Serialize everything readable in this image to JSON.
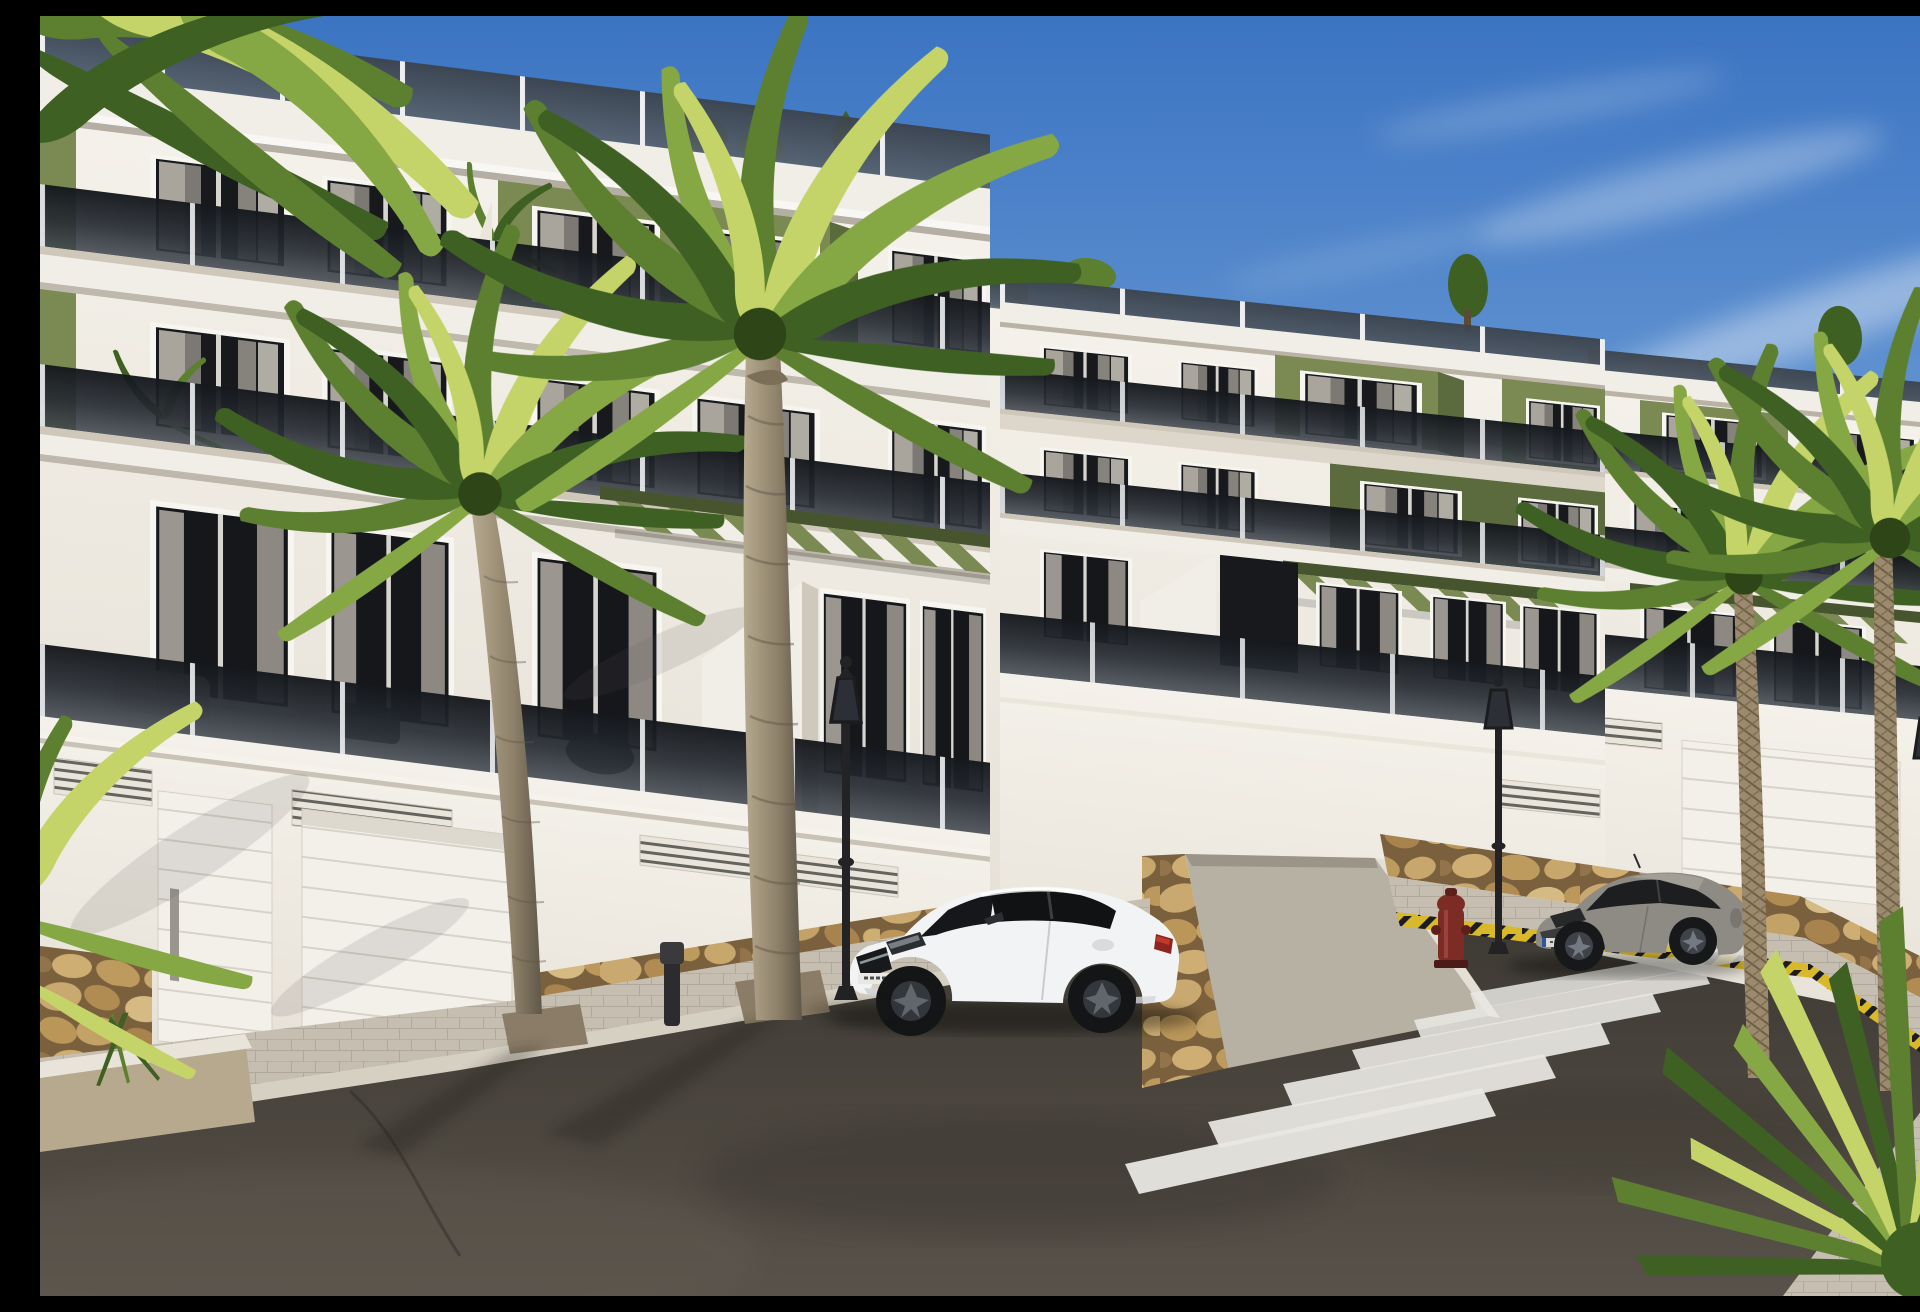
{
  "scene": {
    "title": "New-build apartment complex street view",
    "description": "Photoreal 3D architectural rendering: a terraced three-storey white apartment complex with olive-green accent panels, smoked-glass balustrades, roof terraces and slatted pergolas, above a garage level with white doors and a natural-stone plinth. A palm-lined asphalt street runs diagonally in front with a zebra crosswalk, a parked white coupe and a parked grey coupe, classic lantern street lamps, a red fire hydrant and a yellow-black hazard kerb under a clear blue sky with thin cirrus clouds.",
    "weather": "sunny, clear blue sky, light wispy clouds",
    "time_of_day": "daytime"
  },
  "buildings": [
    {
      "id": "block-a",
      "position": "left foreground",
      "floors_above_garage": 3,
      "features": [
        "roof terrace with smoked glass railing",
        "white fascia cornice",
        "olive green feature panel",
        "smoked glass balcony balustrades",
        "curtained window openings",
        "olive slatted pergola",
        "angled white stair wall",
        "garage level with two white doors",
        "ventilation grilles",
        "rubble stone plinth",
        "rooftop shrubs"
      ]
    },
    {
      "id": "block-b",
      "position": "centre, receding",
      "floors_above_garage": 3,
      "features": [
        "roof terrace railing",
        "two olive green balcony boxes",
        "olive feature wall",
        "pergola",
        "dark entrance recess",
        "vent grille",
        "stone plinth"
      ]
    },
    {
      "id": "block-c",
      "position": "far right",
      "floors_above_garage": 3,
      "features": [
        "roof terrace railing",
        "olive green panels",
        "balconies",
        "pergola",
        "white garage door",
        "stone plinth"
      ]
    }
  ],
  "street": {
    "surface": "dark asphalt",
    "crosswalk_stripes": 6,
    "elements": [
      "paved sidewalk with kerb",
      "planter boxes with gravel",
      "palm tree pits",
      "driveway ramp between stone walls",
      "far-side paved apron",
      "yellow-black hazard kerb",
      "asphalt crack"
    ]
  },
  "vehicles": [
    {
      "id": "white-coupe",
      "type": "two-door coupe",
      "color": "white",
      "state": "parked facing left, centre foreground"
    },
    {
      "id": "grey-coupe",
      "type": "two-door coupe",
      "color": "grey",
      "state": "parked facing left beside the crosswalk"
    }
  ],
  "street_furniture": [
    {
      "id": "street-lamp-1",
      "type": "classic lantern lamp post",
      "position": "centre-left"
    },
    {
      "id": "street-lamp-2",
      "type": "classic lantern lamp post",
      "position": "right of driveway"
    },
    {
      "id": "street-lamp-3",
      "type": "classic lantern lamp post",
      "position": "far right among palms"
    },
    {
      "id": "fire-hydrant",
      "type": "fire hydrant",
      "color": "dark red"
    },
    {
      "id": "bollard",
      "type": "dark bollard"
    }
  ],
  "vegetation": [
    {
      "id": "palm-large-centre",
      "type": "tall palm tree",
      "position": "in front of left building"
    },
    {
      "id": "palm-left",
      "type": "tall palm tree",
      "position": "left, trunk crossing garage wall"
    },
    {
      "id": "palm-right-pair",
      "type": "two fan palms",
      "position": "in front of right building"
    },
    {
      "id": "corner-fronds",
      "type": "palm fronds entering frame",
      "position": "top left and left edge"
    },
    {
      "id": "yucca",
      "type": "spiky yucca plant",
      "position": "bottom right corner"
    },
    {
      "id": "rooftop-shrubs",
      "type": "small conifers and shrubs",
      "position": "on roof terraces"
    },
    {
      "id": "balcony-plants",
      "type": "potted plants",
      "position": "on balconies and terraces"
    }
  ],
  "colors": {
    "sky_top": "#3b74c2",
    "sky_mid": "#7fabdd",
    "sky_horizon": "#c9def2",
    "facade": "#f1eee7",
    "facade_shadow": "#ddd7cb",
    "soffit": "#cfc8ba",
    "frame": "#f7f5f0",
    "olive": "#7b8a53",
    "olive_dark": "#5c6b3d",
    "olive_deep": "#47552f",
    "glass_deep": "#17191d",
    "stone_joint": "#7a603c",
    "pavement": "#c6bfb1",
    "kerb": "#d6d0c3",
    "road": "#48433d",
    "lamp": "#232326",
    "hydrant": "#7c2b25",
    "car_white": "#f2f3f4",
    "car_grey": "#8e8a84",
    "hazard_yellow": "#d9b92c",
    "hazard_black": "#1d1d1f",
    "palm_dark": "#3f6023",
    "palm_mid": "#5d8030",
    "palm_light": "#86a844",
    "palm_yellow": "#c4d468"
  }
}
